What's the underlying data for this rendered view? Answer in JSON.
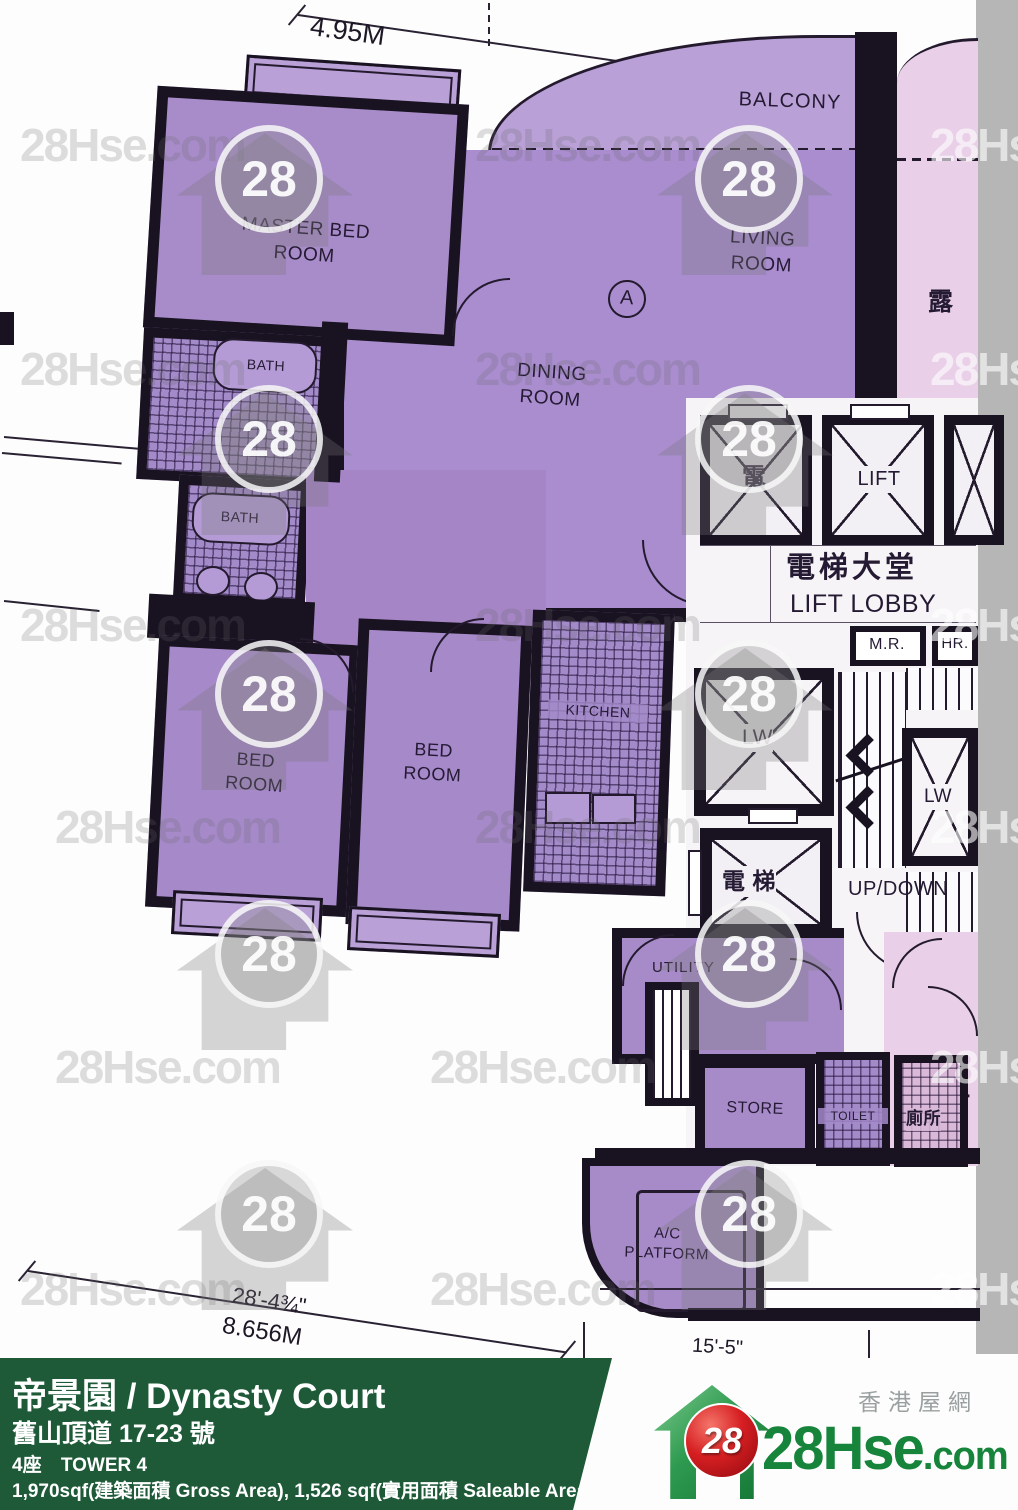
{
  "watermark": {
    "text": "28Hse.com",
    "badge": "28"
  },
  "dims": {
    "top": "4.95M",
    "bottom_ft": "28'-4¾\"",
    "bottom_m": "8.656M",
    "right_ft": "15'-5\""
  },
  "rooms": {
    "marker": "A",
    "master_bedroom": "MASTER BED ROOM",
    "balcony": "BALCONY",
    "living_room": "LIVING ROOM",
    "dining_room": "DINING ROOM",
    "bath_upper": "BATH",
    "bath_lower": "BATH",
    "bedroom_left": "BED ROOM",
    "bedroom_right": "BED ROOM",
    "kitchen": "KITCHEN",
    "utility": "UTILITY",
    "store": "STORE",
    "toilet": "TOILET",
    "toilet_zh": "廁所",
    "ac_platform": "A/C PLATFORM",
    "neighbor_balcony_zh": "露",
    "neighbor_partial_zh": "士"
  },
  "core": {
    "lift_shaft_zh": "電",
    "lift": "LIFT",
    "lobby_zh": "電梯大堂",
    "lobby_en": "LIFT LOBBY",
    "meter_room": "M.R.",
    "hose_reel": "HR.",
    "lw_left": "LW",
    "lw_right": "LW",
    "lift2_zh": "電 梯",
    "stairs": "UP/DOWN"
  },
  "footer": {
    "title": "帝景園 / Dynasty Court",
    "address": "舊山頂道 17-23 號",
    "tower_zh": "4座",
    "tower_en": "TOWER 4",
    "areas": "1,970sqf(建築面積 Gross Area), 1,526 sqf(實用面積 Saleable Area)",
    "brand_main": "28Hse",
    "brand_suffix": ".com",
    "brand_zh": "香港屋網",
    "brand_badge": "28"
  }
}
